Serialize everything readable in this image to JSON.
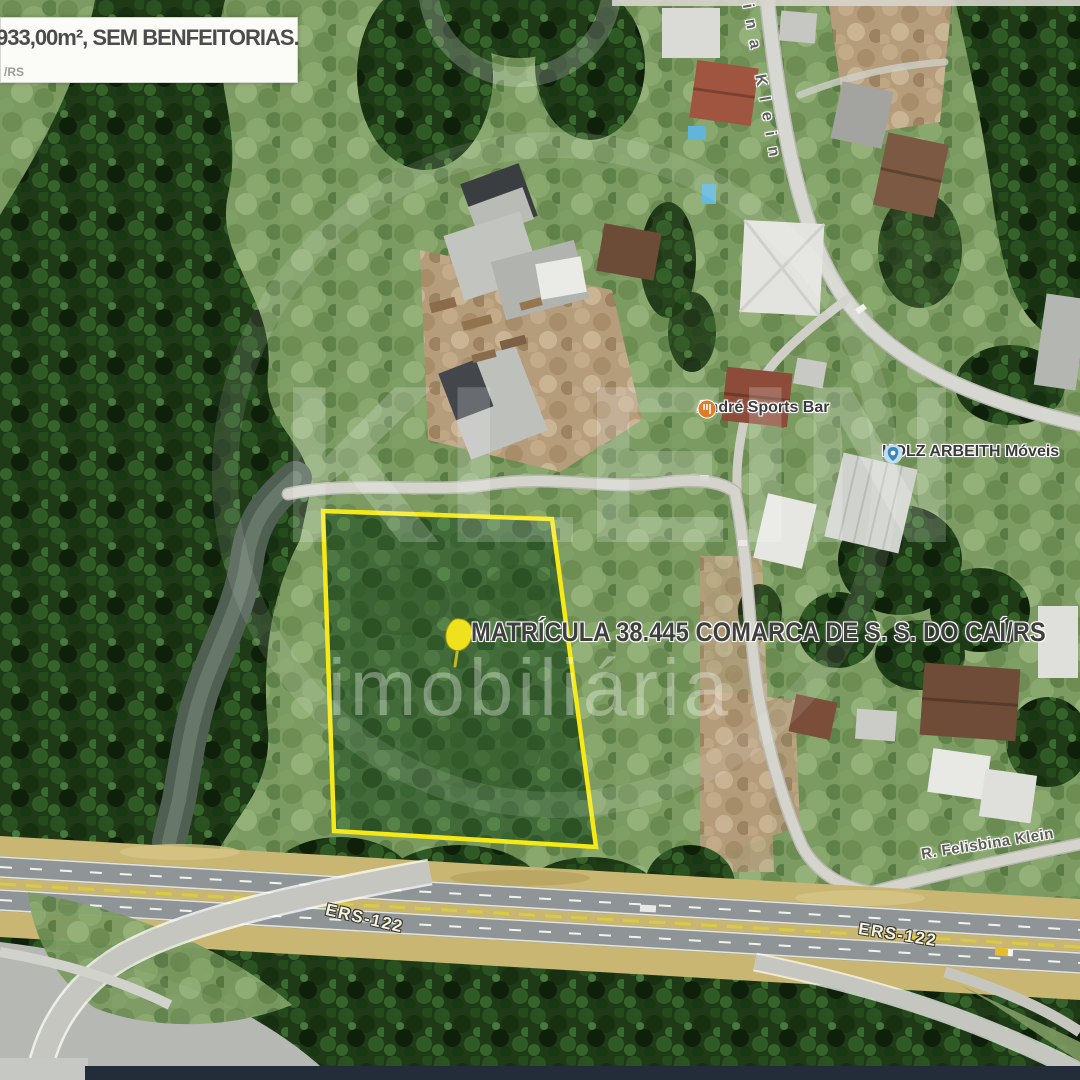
{
  "info_box": {
    "area_text": "933,00m², SEM BENFEITORIAS.",
    "corner_text": "/RS"
  },
  "labels": {
    "matricula": "MATRÍCULA 38.445 COMARCA DE S. S. DO CAÍ/RS",
    "street_top": "bina Klein",
    "street_bottom": "R. Felisbina Klein",
    "highway_left": "ERS-122",
    "highway_right": "ERS-122",
    "poi_bar": "André Sports Bar",
    "poi_store": "HOLZ ARBEITH Móveis"
  },
  "watermark": {
    "brand": "KLEIN",
    "subtitle": "imobiliária"
  },
  "parcel": {
    "outline_color": "#f6e915",
    "marker": "yellow-pushpin"
  },
  "icons": {
    "poi_bar_icon": "restaurant-pin-icon",
    "poi_store_icon": "shopping-pin-icon"
  },
  "colors": {
    "parcel_outline": "#f6e915",
    "poi_bar_pin": "#e07b28",
    "poi_store_pin": "#3b85bb",
    "info_box_bg": "#fbfbf8",
    "label_text": "#3e3e3e",
    "highway_asphalt": "#8f9496",
    "highway_shoulder": "#c8b672"
  }
}
